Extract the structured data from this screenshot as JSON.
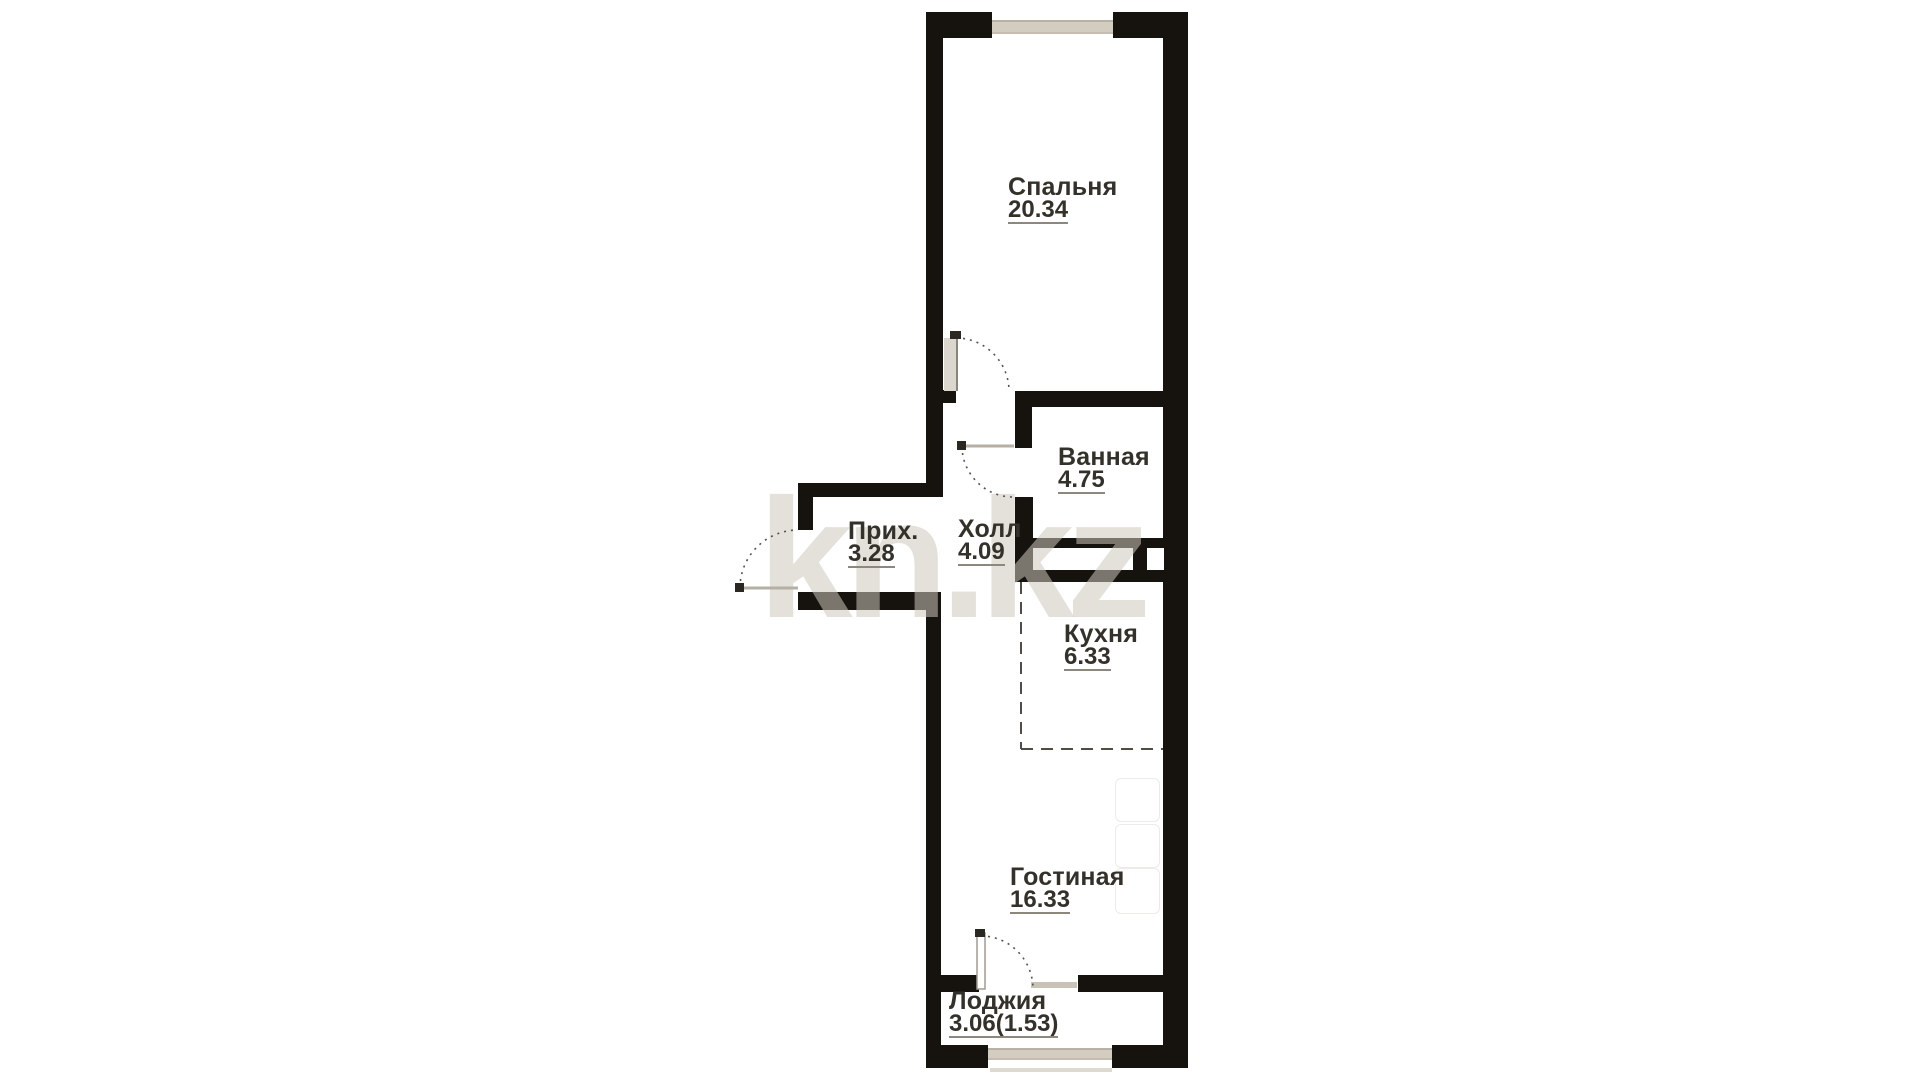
{
  "watermark": "kn.kz",
  "rooms": {
    "bedroom": {
      "name": "Спальня",
      "area": "20.34"
    },
    "bathroom": {
      "name": "Ванная",
      "area": "4.75"
    },
    "entry": {
      "name": "Прих.",
      "area": "3.28"
    },
    "hall": {
      "name": "Холл",
      "area": "4.09"
    },
    "kitchen": {
      "name": "Кухня",
      "area": "6.33"
    },
    "living": {
      "name": "Гостиная",
      "area": "16.33"
    },
    "loggia": {
      "name": "Лоджия",
      "area": "3.06(1.53)"
    }
  },
  "colors": {
    "wall": "#16130f",
    "window_glass": "#d2ccc1",
    "label_text": "#34302a",
    "area_underline": "#8d887e",
    "door_arc": "#57534c",
    "kitchen_dashed_line": "#514d46",
    "watermark": "#cdc7bc"
  }
}
